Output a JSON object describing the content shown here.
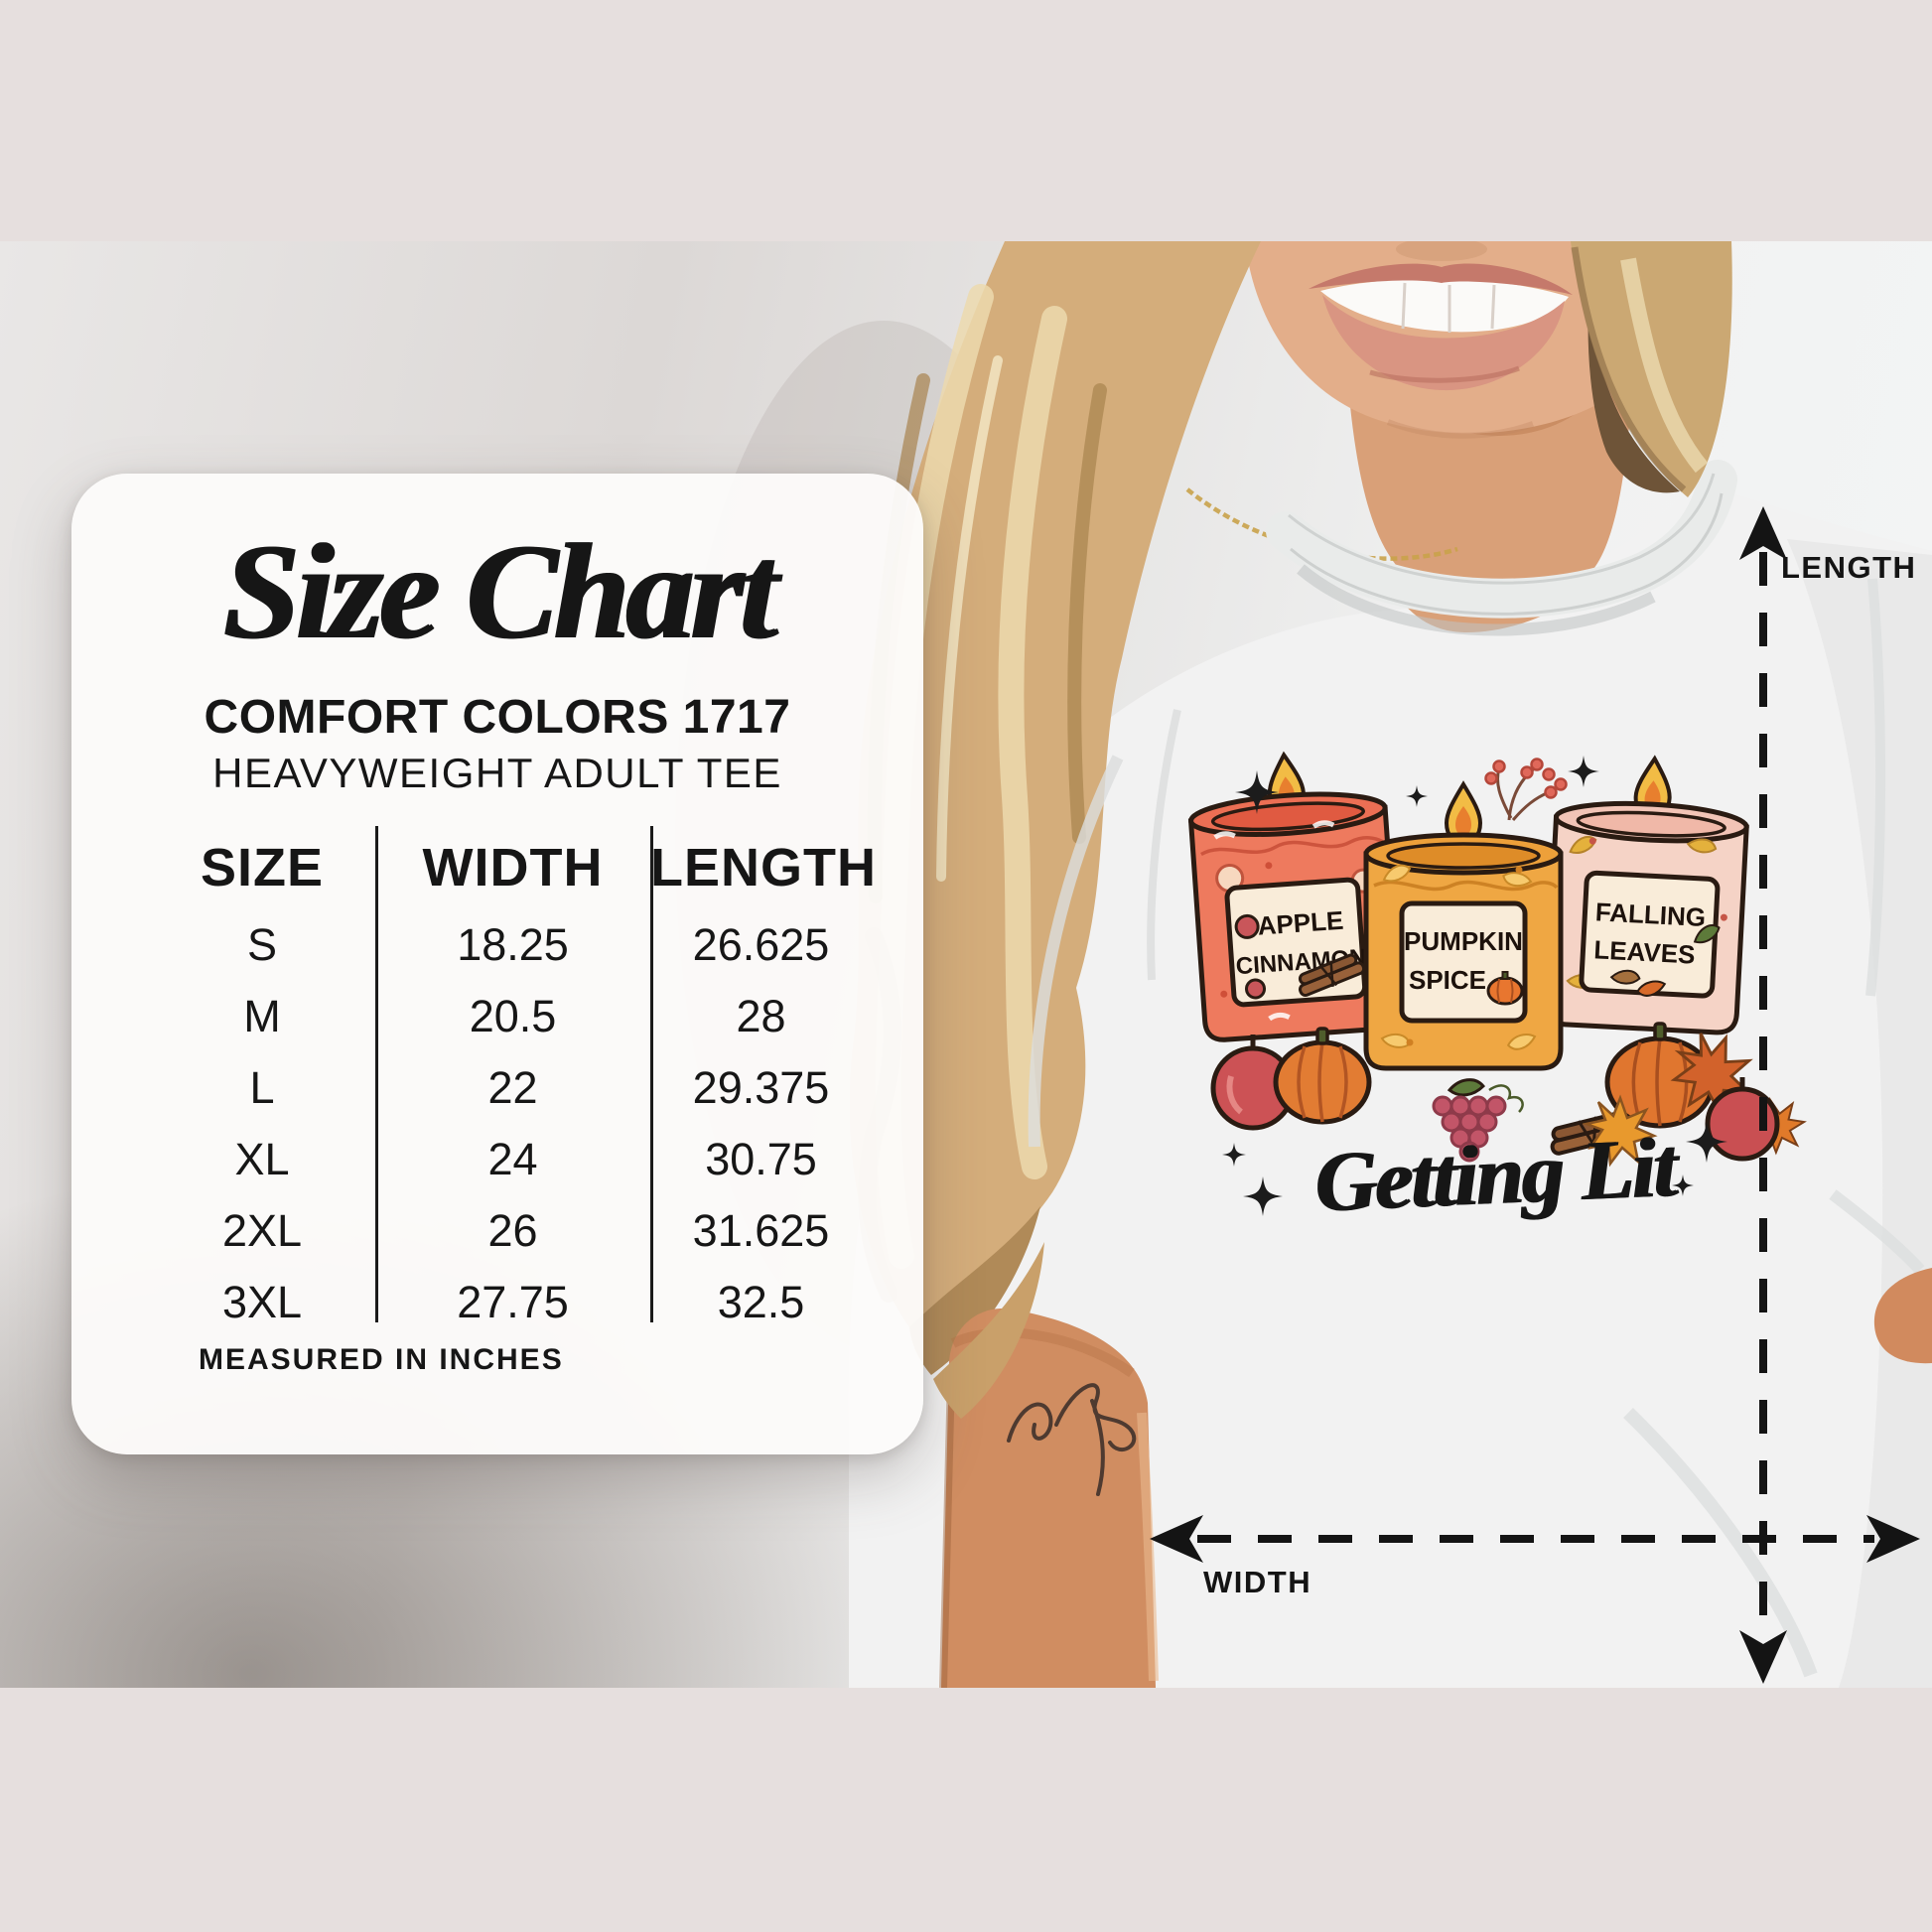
{
  "palette": {
    "frame": "#e6dfde",
    "ink": "#161616",
    "card_bg": "#fbfafa",
    "tee": "#f2f2f2",
    "skin": "#d9a078",
    "hair": "#d4ad7b",
    "candle_red": "#ee7a5e",
    "candle_orange": "#efa743",
    "candle_pink": "#f5d3c6",
    "flame_gold": "#f2bc45",
    "flame_inner": "#e87f2e",
    "label_cream": "#f9ecd9",
    "arrow": "#141414",
    "outline": "#2a1b12"
  },
  "card": {
    "title": "Size Chart",
    "brand": "COMFORT COLORS 1717",
    "product": "HEAVYWEIGHT ADULT TEE",
    "note": "MEASURED IN INCHES",
    "table": {
      "columns": [
        "SIZE",
        "WIDTH",
        "LENGTH"
      ],
      "rows": [
        {
          "size": "S",
          "width": "18.25",
          "length": "26.625"
        },
        {
          "size": "M",
          "width": "20.5",
          "length": "28"
        },
        {
          "size": "L",
          "width": "22",
          "length": "29.375"
        },
        {
          "size": "XL",
          "width": "24",
          "length": "30.75"
        },
        {
          "size": "2XL",
          "width": "26",
          "length": "31.625"
        },
        {
          "size": "3XL",
          "width": "27.75",
          "length": "32.5"
        }
      ]
    }
  },
  "measurements": {
    "vertical_label": "LENGTH",
    "horizontal_label": "WIDTH"
  },
  "shirt": {
    "caption": "Getting Lit",
    "candles": [
      {
        "line1": "APPLE",
        "line2": "CINNAMON"
      },
      {
        "line1": "PUMPKIN",
        "line2": "SPICE"
      },
      {
        "line1": "FALLING",
        "line2": "LEAVES"
      }
    ]
  },
  "chart_data": {
    "type": "table",
    "title": "Size Chart",
    "brand": "COMFORT COLORS 1717",
    "product": "HEAVYWEIGHT ADULT TEE",
    "units": "inches",
    "columns": [
      "SIZE",
      "WIDTH",
      "LENGTH"
    ],
    "rows": [
      [
        "S",
        18.25,
        26.625
      ],
      [
        "M",
        20.5,
        28
      ],
      [
        "L",
        22,
        29.375
      ],
      [
        "XL",
        24,
        30.75
      ],
      [
        "2XL",
        26,
        31.625
      ],
      [
        "3XL",
        27.75,
        32.5
      ]
    ]
  }
}
